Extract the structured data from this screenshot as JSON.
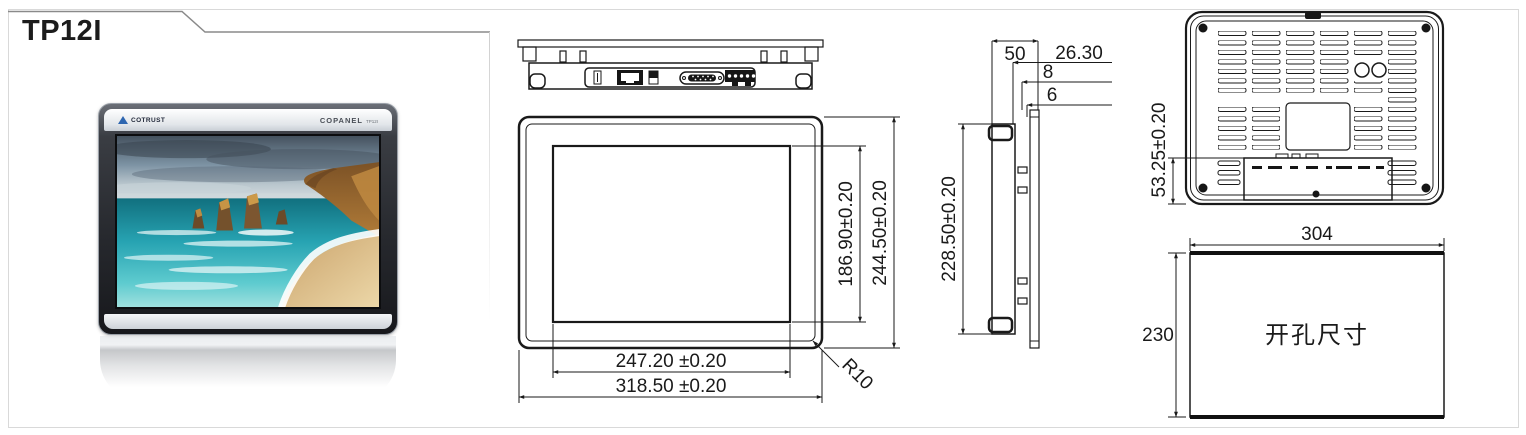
{
  "page": {
    "title": "TP12I"
  },
  "photo": {
    "brand": "COTRUST",
    "series": "COPANEL",
    "model": "TP12I"
  },
  "front_view": {
    "screen_width": "247.20 ±0.20",
    "outer_width": "318.50 ±0.20",
    "screen_height": "186.90±0.20",
    "outer_height": "244.50±0.20",
    "corner_radius": "R10"
  },
  "side_view": {
    "depth": "50",
    "offset_a": "26.30",
    "offset_b": "8",
    "offset_c": "6",
    "height": "228.50±0.20"
  },
  "rear_view": {
    "bottom_offset": "53.25±0.20"
  },
  "cutout": {
    "width": "304",
    "height": "230",
    "label": "开孔尺寸"
  }
}
